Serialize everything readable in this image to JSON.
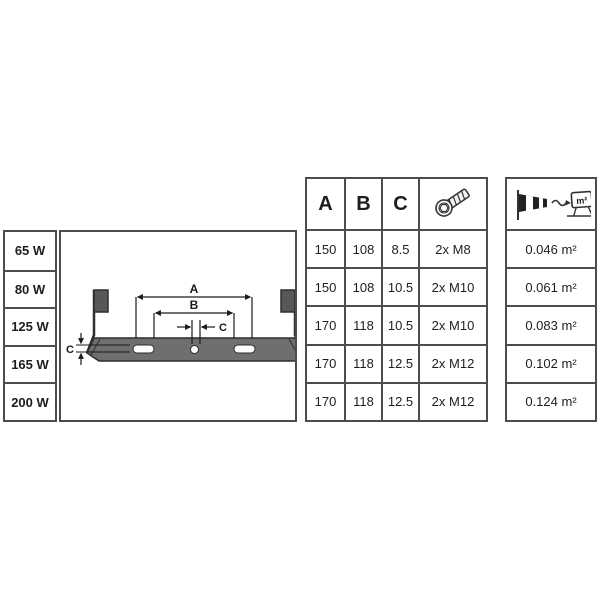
{
  "table": {
    "headers": {
      "a": "A",
      "b": "B",
      "c": "C"
    },
    "header_icons": {
      "screw": "hex-socket-screw-icon",
      "wind_load": "windsock-floodlight-area-icon"
    },
    "wattages": [
      "65 W",
      "80 W",
      "125 W",
      "165 W",
      "200 W"
    ],
    "rows": [
      {
        "a": "150",
        "b": "108",
        "c": "8.5",
        "screws": "2x M8",
        "wind_area": "0.046 m²"
      },
      {
        "a": "150",
        "b": "108",
        "c": "10.5",
        "screws": "2x M10",
        "wind_area": "0.061 m²"
      },
      {
        "a": "170",
        "b": "118",
        "c": "10.5",
        "screws": "2x M10",
        "wind_area": "0.083 m²"
      },
      {
        "a": "170",
        "b": "118",
        "c": "12.5",
        "screws": "2x M12",
        "wind_area": "0.102 m²"
      },
      {
        "a": "170",
        "b": "118",
        "c": "12.5",
        "screws": "2x M12",
        "wind_area": "0.124 m²"
      }
    ]
  },
  "diagram": {
    "dim_a_label": "A",
    "dim_b_label": "B",
    "dim_c_center_label": "C",
    "dim_c_left_label": "C",
    "wind_icon_unit": "m²"
  },
  "colors": {
    "border": "#4d4d4d",
    "text": "#1d1d1d",
    "plate_fill": "#6f6f6f",
    "block_fill": "#575757",
    "outline": "#2e2e2e"
  }
}
